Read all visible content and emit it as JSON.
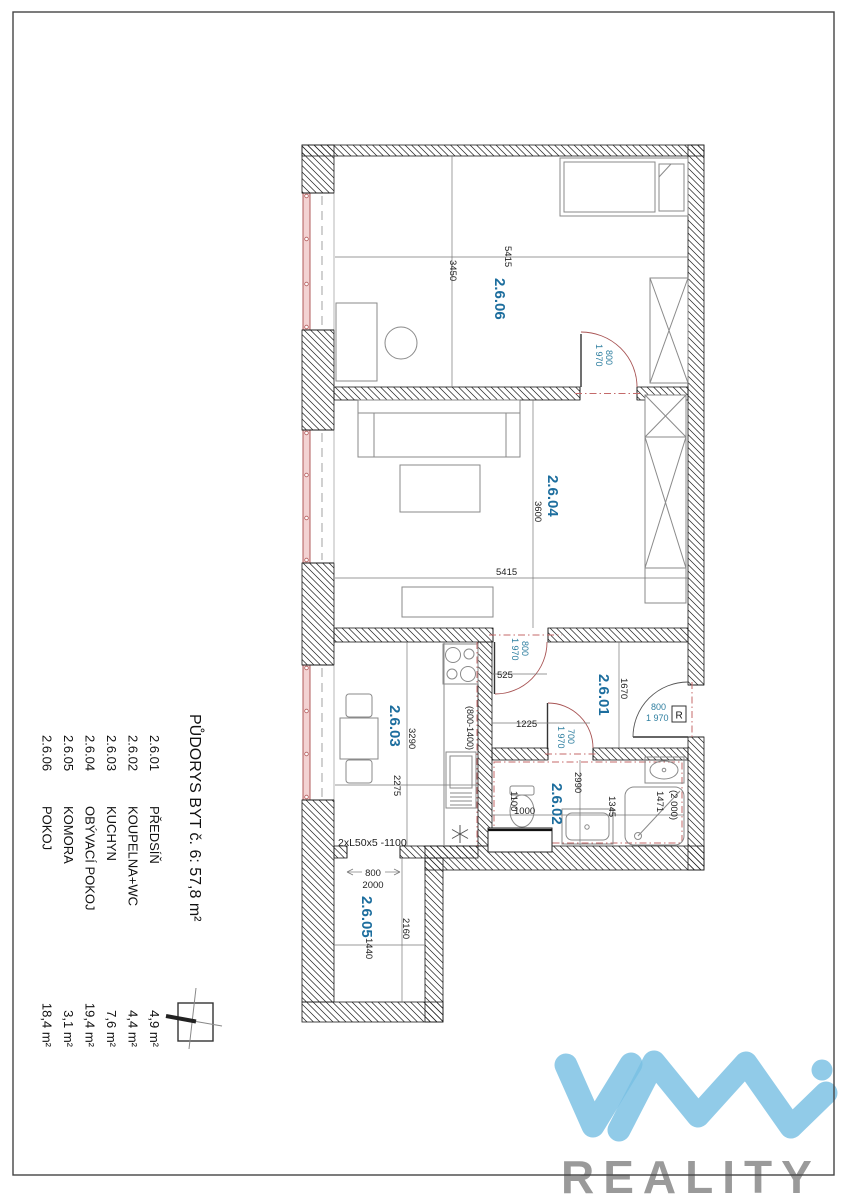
{
  "legend": {
    "title": "PŮDORYS  BYT č. 6: 57,8 m²",
    "rows": [
      {
        "num": "2.6.01",
        "name": "PŘEDSÍŇ",
        "area": "4,9 m²"
      },
      {
        "num": "2.6.02",
        "name": "KOUPELNA+WC",
        "area": "4,4 m²"
      },
      {
        "num": "2.6.03",
        "name": "KUCHYN",
        "area": "7,6 m²"
      },
      {
        "num": "2.6.04",
        "name": "OBÝVACÍ POKOJ",
        "area": "19,4 m²"
      },
      {
        "num": "2.6.05",
        "name": "KOMORA",
        "area": "3,1 m²"
      },
      {
        "num": "2.6.06",
        "name": "POKOJ",
        "area": "18,4 m²"
      }
    ]
  },
  "plan": {
    "room_labels": {
      "hall": "2.6.01",
      "bath": "2.6.02",
      "kitchen": "2.6.03",
      "living": "2.6.04",
      "storage": "2.6.05",
      "bedroom": "2.6.06"
    },
    "dims": {
      "bedroom_w": "5415",
      "bedroom_h": "3450",
      "living_w": "5415",
      "living_h": "3600",
      "kitchen_h": "3290",
      "kitchen_w": "2275",
      "kitchen_cab": "(800-1400)",
      "kitchen_lintel": "2xL50x5 -1100",
      "hall_h": "1670",
      "hall_off1": "525",
      "hall_off2": "1225",
      "bath_w": "2990",
      "bath_wc_depth": "1100",
      "bath_wc": "1000",
      "bath_wm": "1345",
      "bath_tub": "1471",
      "bath_tub2": "(2 000)",
      "storage_door": "800",
      "storage_door_h": "2000",
      "storage_h": "2160",
      "storage_w": "1440"
    },
    "door_labels": {
      "w800": "800",
      "w700": "700",
      "h1970": "1 970",
      "r_box": "R"
    }
  },
  "logo": {
    "brand": "REALITY"
  }
}
